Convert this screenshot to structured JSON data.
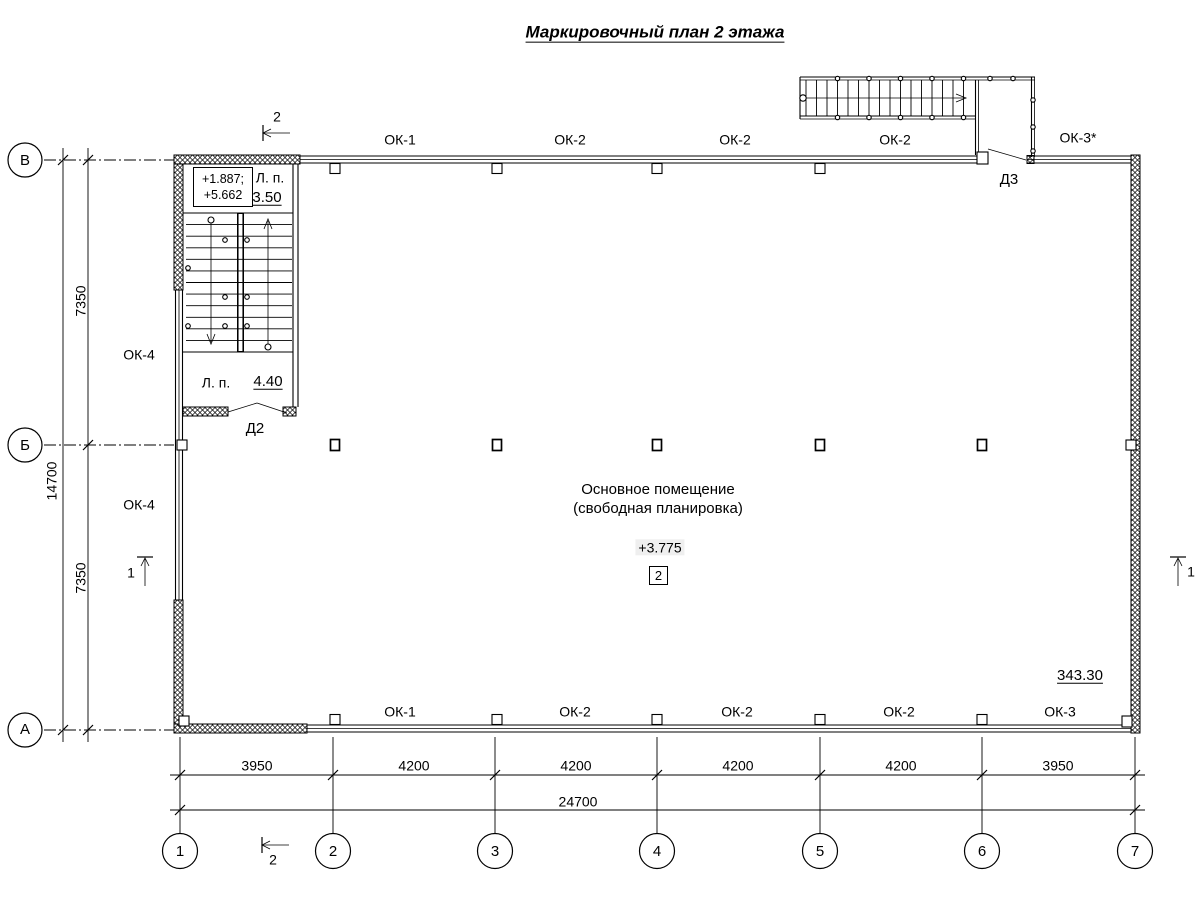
{
  "title": "Маркировочный план 2 этажа",
  "axes": {
    "horizontal": [
      "В",
      "Б",
      "А"
    ],
    "vertical": [
      "1",
      "2",
      "3",
      "4",
      "5",
      "6",
      "7"
    ]
  },
  "dimensions": {
    "left_total": "14700",
    "left_segments": [
      "7350",
      "7350"
    ],
    "bottom_segments": [
      "3950",
      "4200",
      "4200",
      "4200",
      "4200",
      "3950"
    ],
    "bottom_total": "24700"
  },
  "windows": {
    "top": [
      "ОК-1",
      "ОК-2",
      "ОК-2",
      "ОК-2",
      "ОК-3*"
    ],
    "bottom": [
      "ОК-1",
      "ОК-2",
      "ОК-2",
      "ОК-2",
      "ОК-3"
    ],
    "left": [
      "ОК-4",
      "ОК-4"
    ]
  },
  "doors": {
    "d2": "Д2",
    "d3": "Д3"
  },
  "stairwell": {
    "elevation_line1": "+1.887;",
    "elevation_line2": "+5.662",
    "upper_landing_label": "Л. п.",
    "upper_landing_area": "3.50",
    "lower_landing_label": "Л. п.",
    "lower_landing_area": "4.40"
  },
  "room": {
    "name_line1": "Основное помещение",
    "name_line2": "(свободная планировка)",
    "elevation": "+3.775",
    "number": "2",
    "area": "343.30"
  },
  "section_markers": {
    "marker1": "1",
    "marker2": "2"
  }
}
